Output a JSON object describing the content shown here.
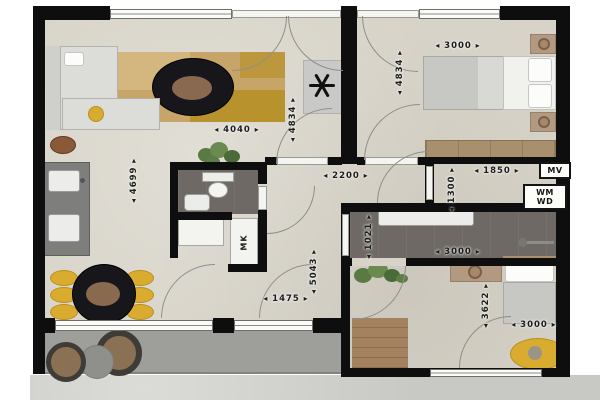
{
  "theme": {
    "wall": "#0e0e0e",
    "floor": "#d7d3c8",
    "darkroom": "#6e6964",
    "balcony": "#9e9e9b",
    "concrete": "#c8c8c4",
    "rugTan": "#c7a468",
    "rugMustard": "#b8922c",
    "accentYellow": "#d9ab2e",
    "wood": "#a8906e",
    "kitchen": "#7e7e7c",
    "plant": "#5f7d46"
  },
  "dimensions": {
    "living_width": "4040",
    "living_depth": "4699",
    "living_wall": "4834",
    "bedroom1_width": "3000",
    "bedroom1_depth": "4834",
    "hall_width": "2200",
    "tech_width": "1850",
    "tech_depth": "1300",
    "utility_depth": "1021",
    "utility_width": "3000",
    "entry_width": "1475",
    "entry_depth": "5043",
    "bedroom2_depth": "3622",
    "bedroom2_width": "3000"
  },
  "labels": {
    "mechanical_vent": "MV",
    "washing_machine": "WM",
    "dryer": "WD",
    "meter_cupboard": "MK"
  }
}
